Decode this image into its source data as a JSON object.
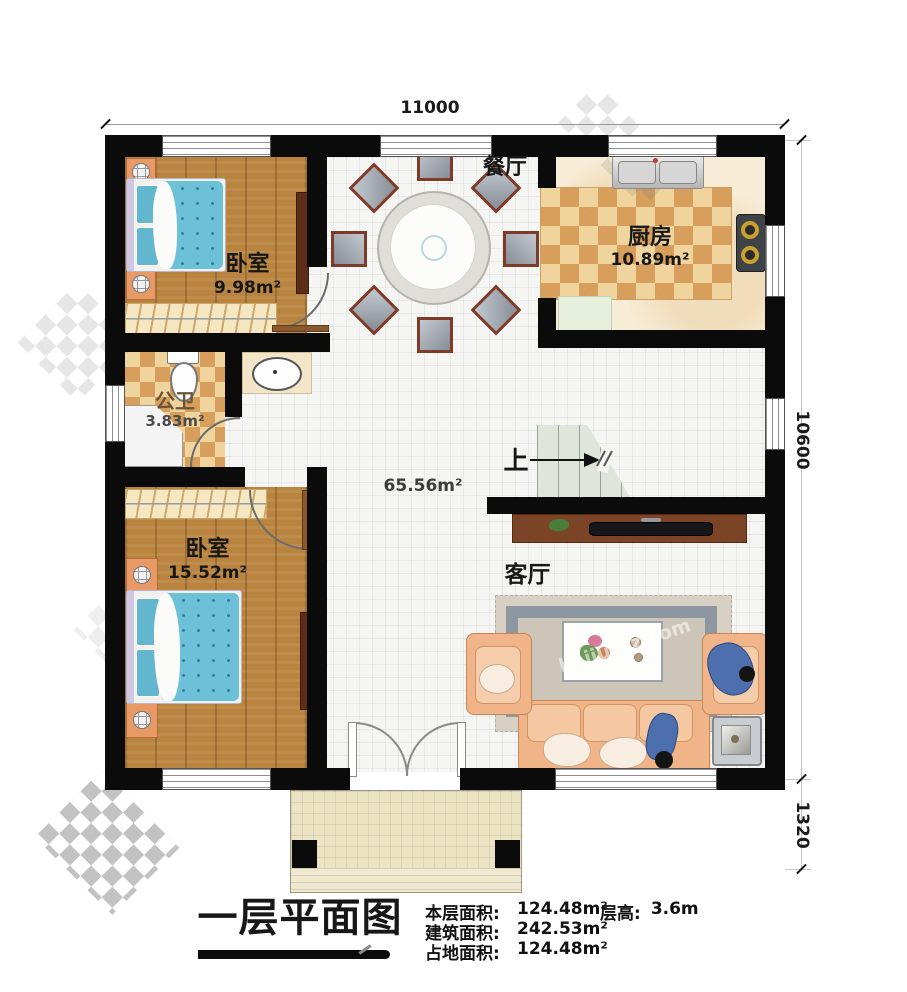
{
  "dimensions": {
    "top": "11000",
    "right_upper": "10600",
    "right_lower": "1320"
  },
  "rooms": {
    "dining": {
      "name": "餐厅"
    },
    "kitchen": {
      "name": "厨房",
      "area": "10.89m²"
    },
    "bedroom1": {
      "name": "卧室",
      "area": "9.98m²"
    },
    "bathroom": {
      "name": "公卫",
      "area": "3.83m²"
    },
    "bedroom2": {
      "name": "卧室",
      "area": "15.52m²"
    },
    "living": {
      "name": "客厅"
    },
    "hall": {
      "area": "65.56m²"
    },
    "stairs": {
      "up_label": "上"
    }
  },
  "footer": {
    "title": "一层平面图",
    "stats": [
      {
        "label": "本层面积:",
        "value": "124.48m²"
      },
      {
        "label": "建筑面积:",
        "value": "242.53m²"
      },
      {
        "label": "占地面积:",
        "value": "124.48m²"
      }
    ],
    "height_label": "层高:",
    "height_value": "3.6m"
  },
  "watermark": {
    "text": "baijunfz.com"
  },
  "colors": {
    "wall": "#0b0b0b",
    "wood_floor": "#b9843f",
    "checker_light": "#efd49e",
    "checker_dark": "#d79e5c",
    "bed_blue": "#6cc0d8",
    "sofa_peach": "#f0b488",
    "stairs": "#dfe5db",
    "cabinet_brown": "#7c4426",
    "porch": "#ece3c3"
  }
}
